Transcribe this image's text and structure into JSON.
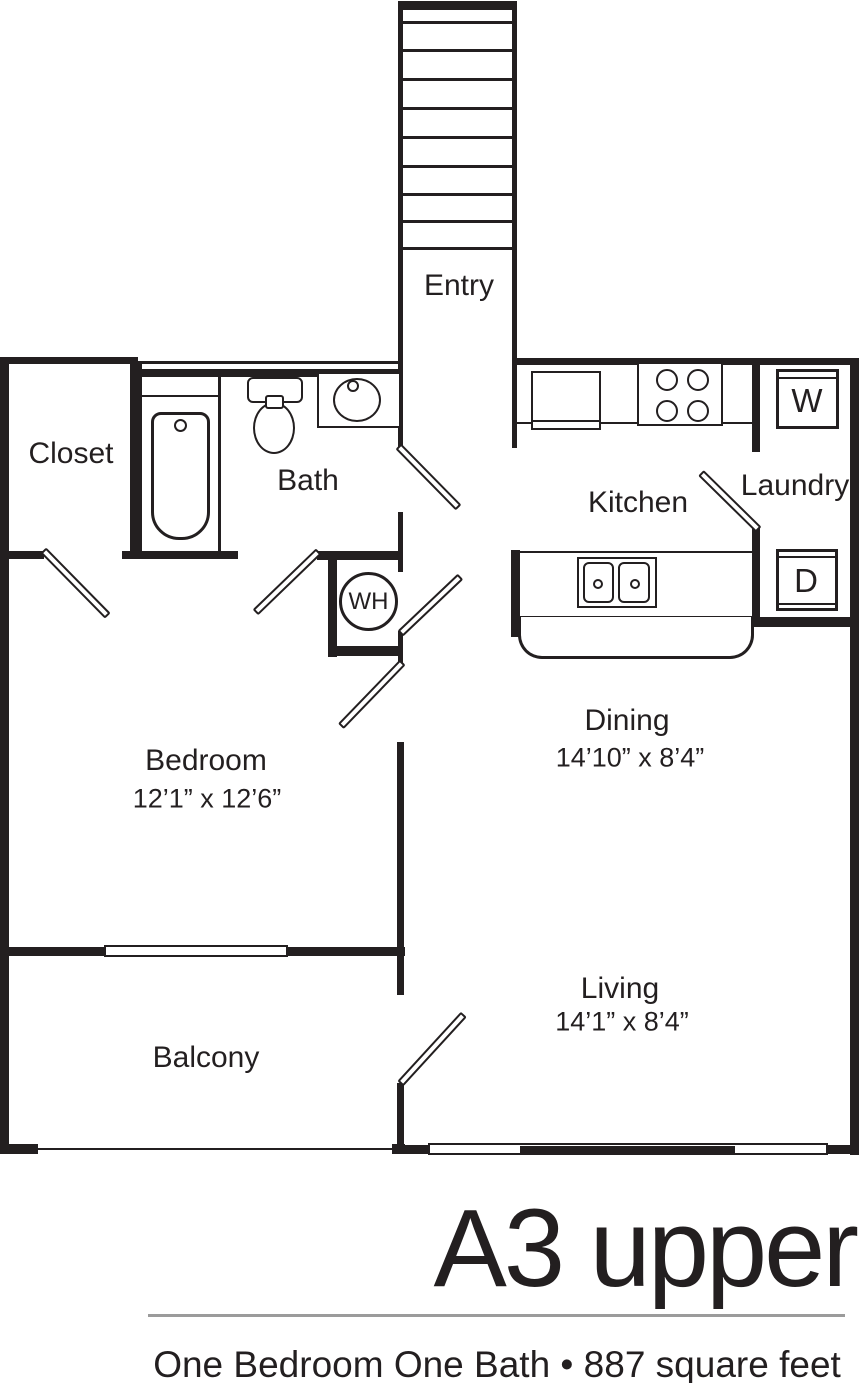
{
  "colors": {
    "line": "#231f20",
    "divider": "#9b9b9b",
    "background": "#ffffff"
  },
  "stairwell": {
    "entry_label": "Entry"
  },
  "rooms": {
    "closet": {
      "label": "Closet"
    },
    "bath": {
      "label": "Bath"
    },
    "kitchen": {
      "label": "Kitchen"
    },
    "laundry": {
      "label": "Laundry"
    },
    "bedroom": {
      "label": "Bedroom",
      "dims": "12’1” x 12’6”"
    },
    "dining": {
      "label": "Dining",
      "dims": "14’10” x 8’4”"
    },
    "living": {
      "label": "Living",
      "dims": "14’1” x 8’4”"
    },
    "balcony": {
      "label": "Balcony"
    }
  },
  "fixtures": {
    "water_heater_label": "WH",
    "washer_label": "W",
    "dryer_label": "D"
  },
  "footer": {
    "plan_name": "A3 upper",
    "description": "One Bedroom One Bath • 887 square feet"
  }
}
